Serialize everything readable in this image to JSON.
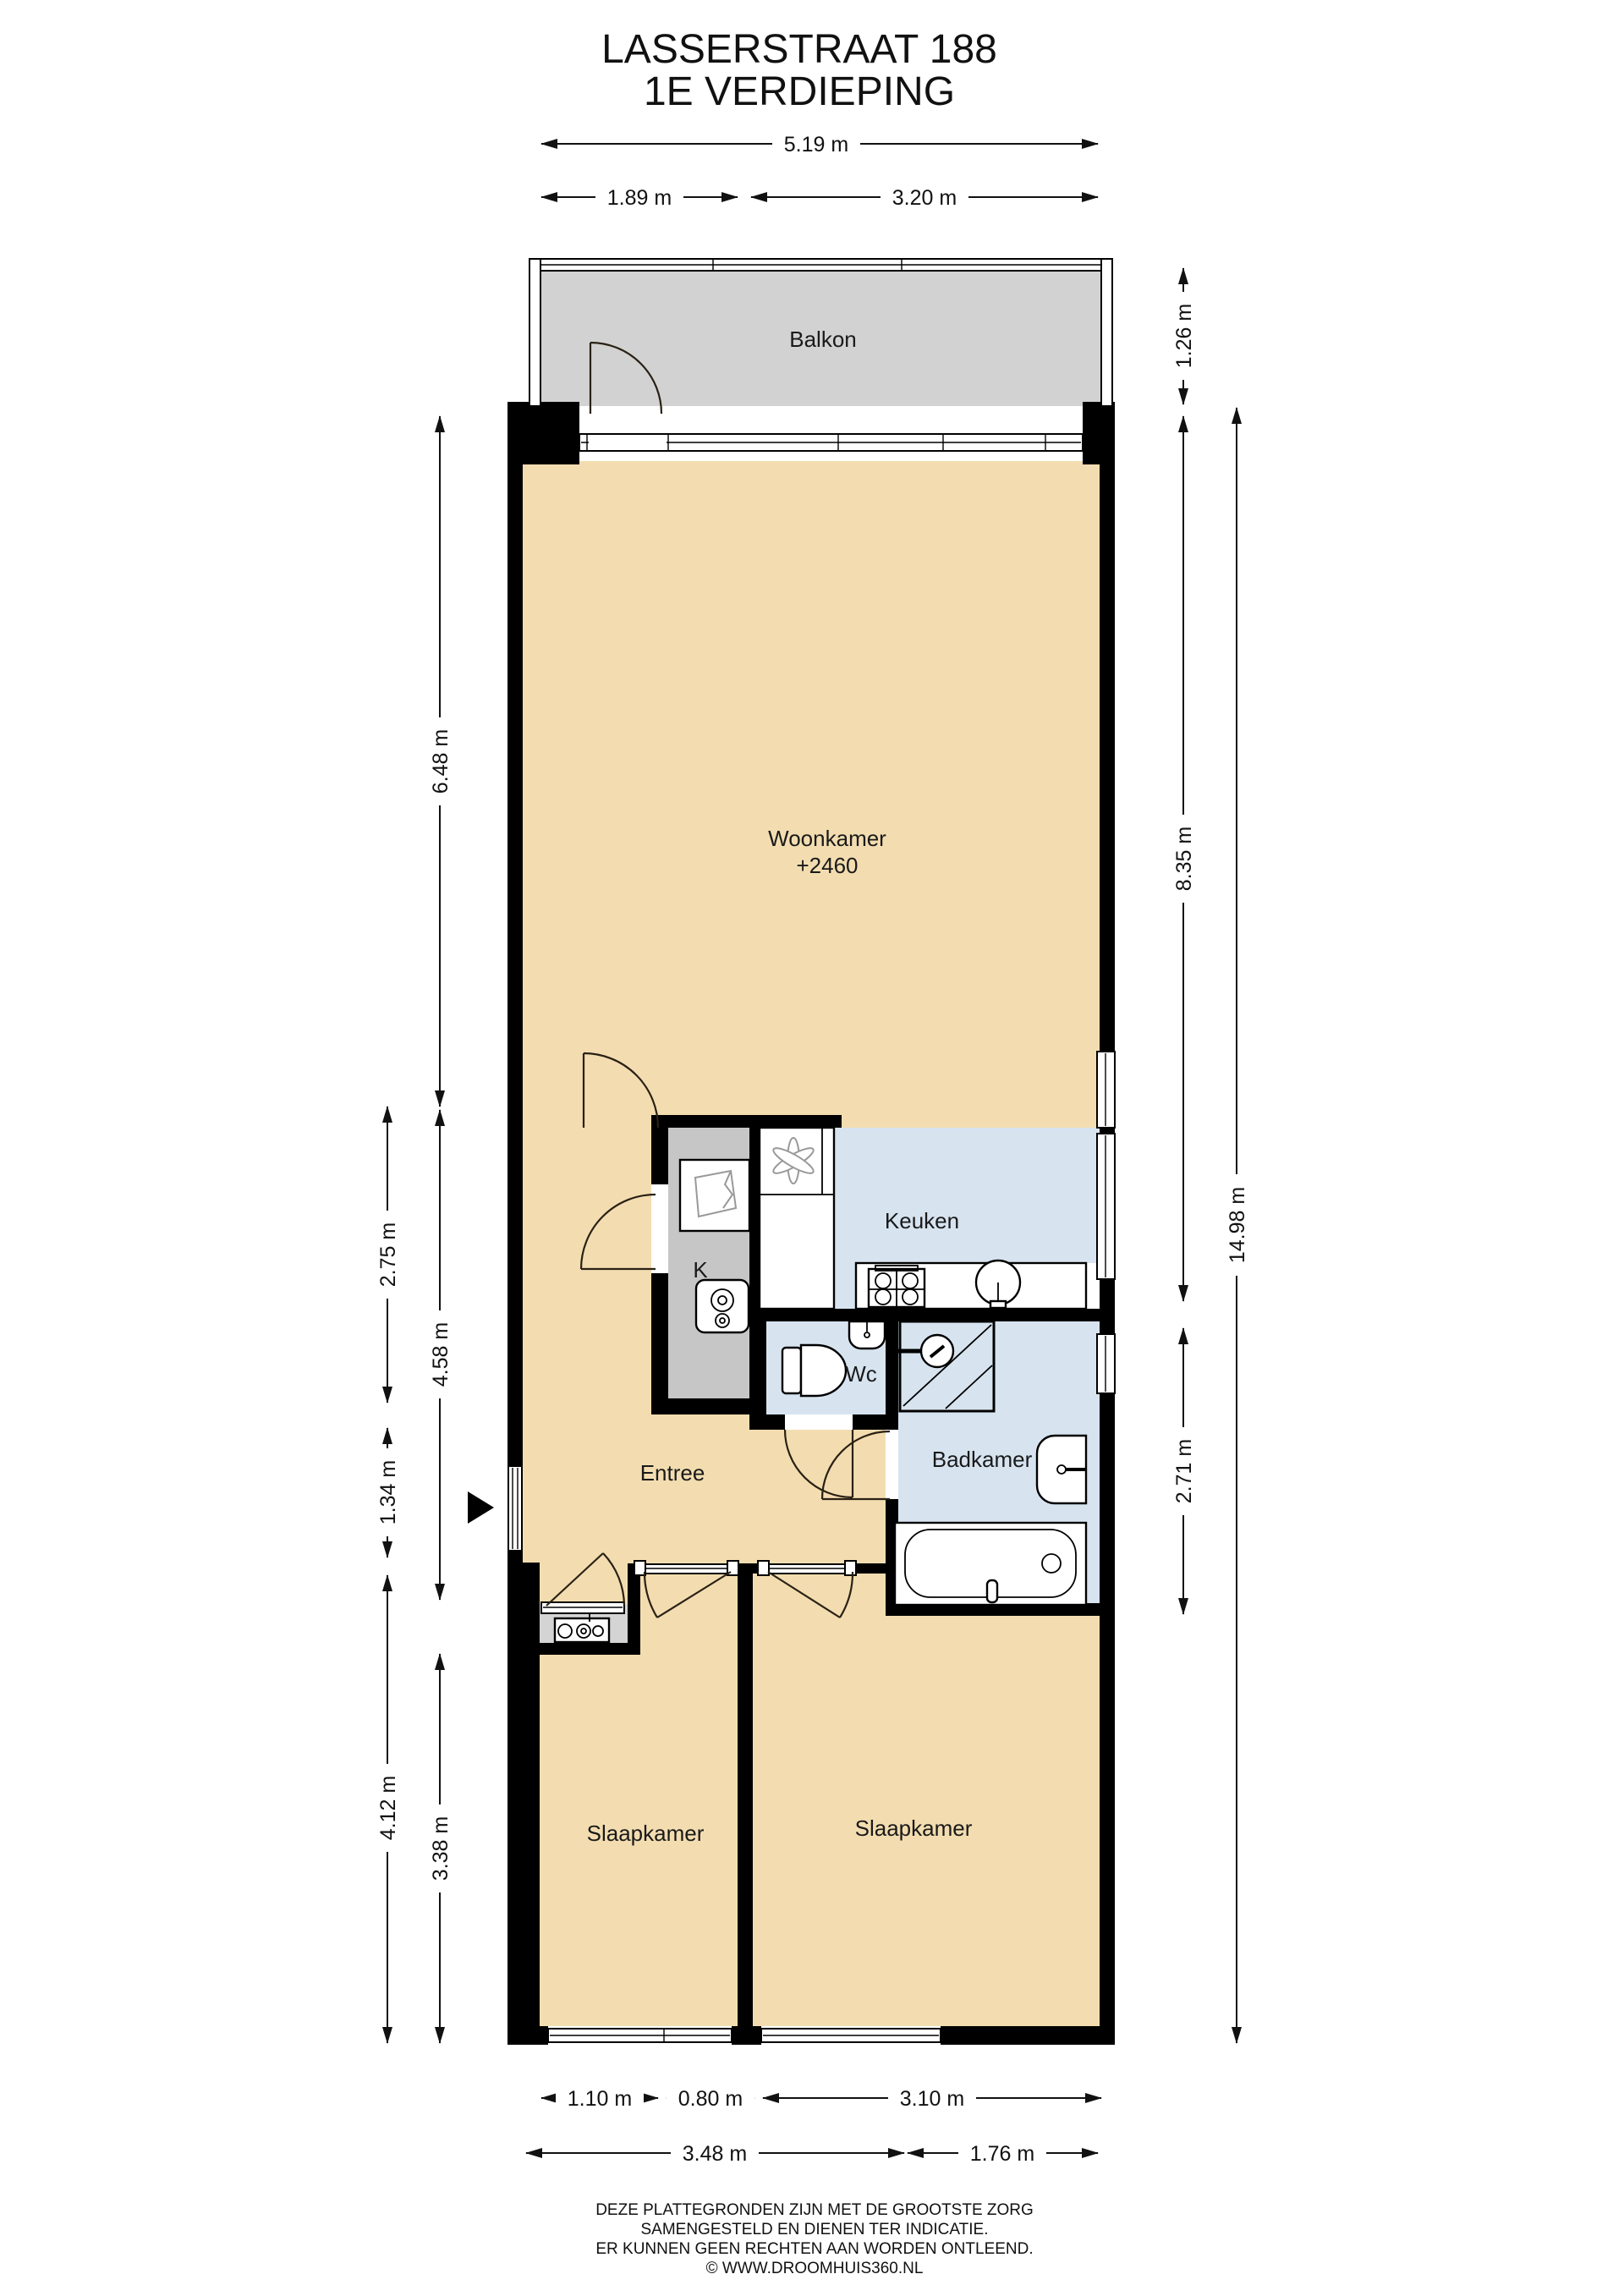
{
  "title": {
    "line1": "LASSERSTRAAT 188",
    "line2": "1E VERDIEPING"
  },
  "rooms": {
    "balkon": "Balkon",
    "woonkamer": "Woonkamer",
    "woonkamer_ceiling": "+2460",
    "keuken": "Keuken",
    "kast": "K",
    "wc": "Wc",
    "badkamer": "Badkamer",
    "entree": "Entree",
    "slaapkamer_left": "Slaapkamer",
    "slaapkamer_right": "Slaapkamer"
  },
  "dims": {
    "top_total": "5.19 m",
    "top_left": "1.89 m",
    "top_right": "3.20 m",
    "balkon_depth": "1.26 m",
    "right_upper": "8.35 m",
    "right_lower": "2.71 m",
    "right_total": "14.98 m",
    "left_woonkamer": "6.48 m",
    "left_mid": "4.58 m",
    "left_hall_upper": "2.75 m",
    "left_hall_lower": "1.34 m",
    "left_bedroom_outer": "4.12 m",
    "left_bedroom_inner": "3.38 m",
    "bottom_win1": "1.10 m",
    "bottom_win2": "0.80 m",
    "bottom_win3": "3.10 m",
    "bottom_total_left": "3.48 m",
    "bottom_total_right": "1.76 m"
  },
  "footer": {
    "line1": "DEZE PLATTEGRONDEN ZIJN MET DE GROOTSTE ZORG",
    "line2": "SAMENGESTELD EN DIENEN TER INDICATIE.",
    "line3": "ER KUNNEN GEEN RECHTEN AAN WORDEN ONTLEEND.",
    "line4": "© WWW.DROOMHUIS360.NL"
  },
  "colors": {
    "floor": "#f3ddb0",
    "balcony": "#d2d2d2",
    "wet": "#d7e4f0",
    "closet": "#c6c6c6",
    "niche": "#d4d4d4"
  }
}
